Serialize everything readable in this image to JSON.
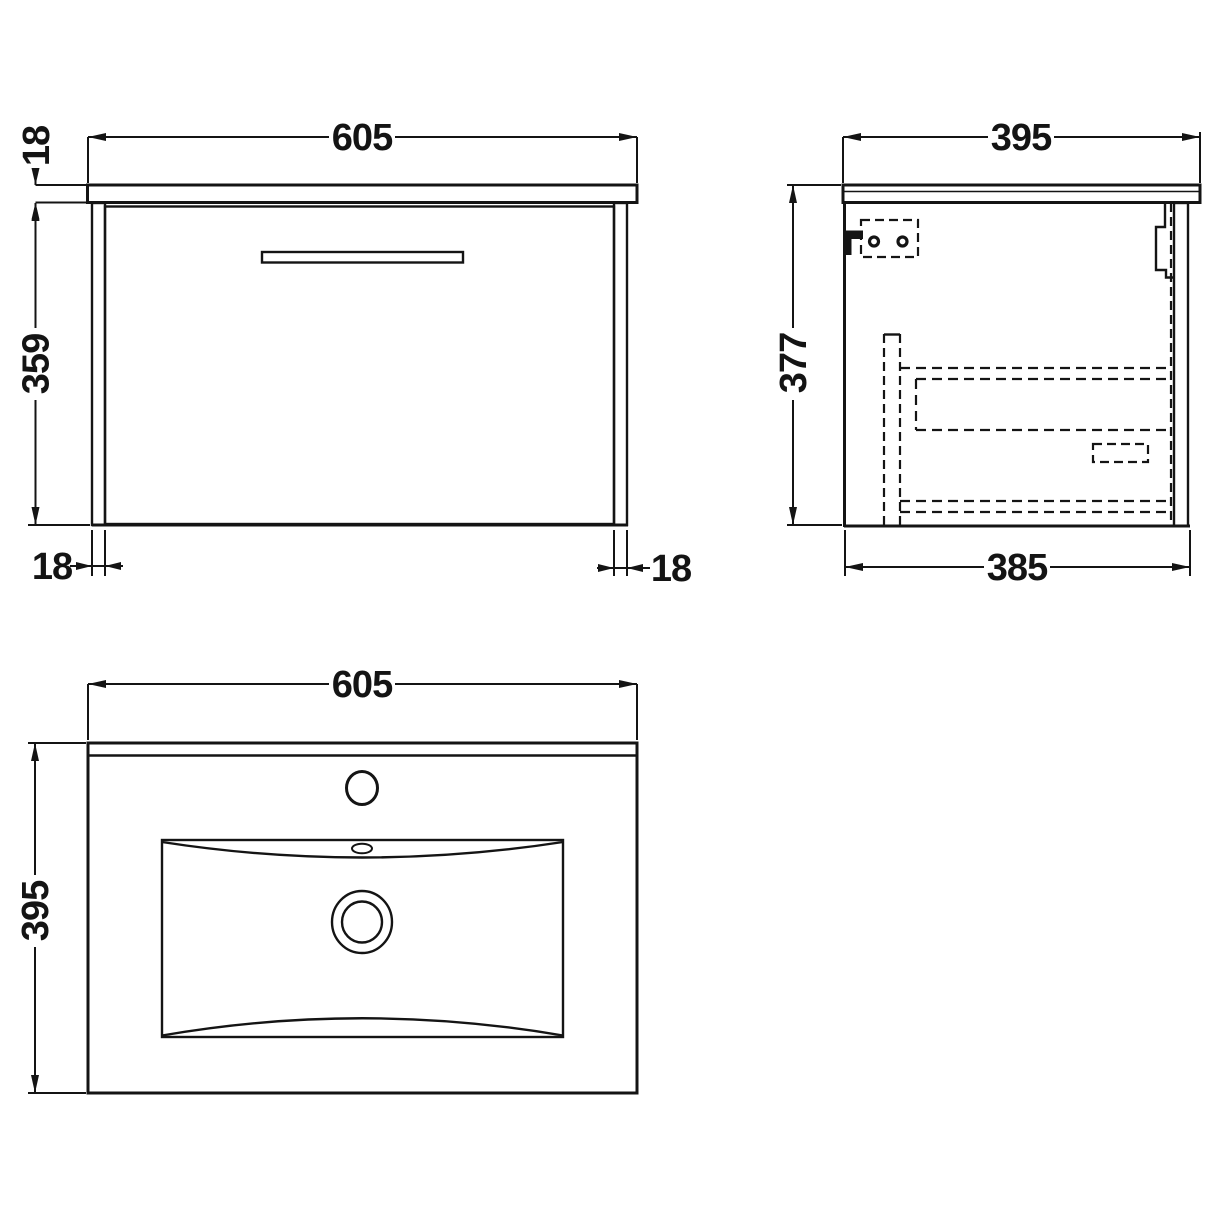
{
  "front_view": {
    "width": "605",
    "worktop_thickness": "18",
    "cabinet_height": "359",
    "left_panel": "18",
    "right_panel": "18"
  },
  "side_view": {
    "overall_depth": "395",
    "overall_height": "377",
    "cabinet_depth": "385"
  },
  "plan_view": {
    "width": "605",
    "depth": "395"
  }
}
